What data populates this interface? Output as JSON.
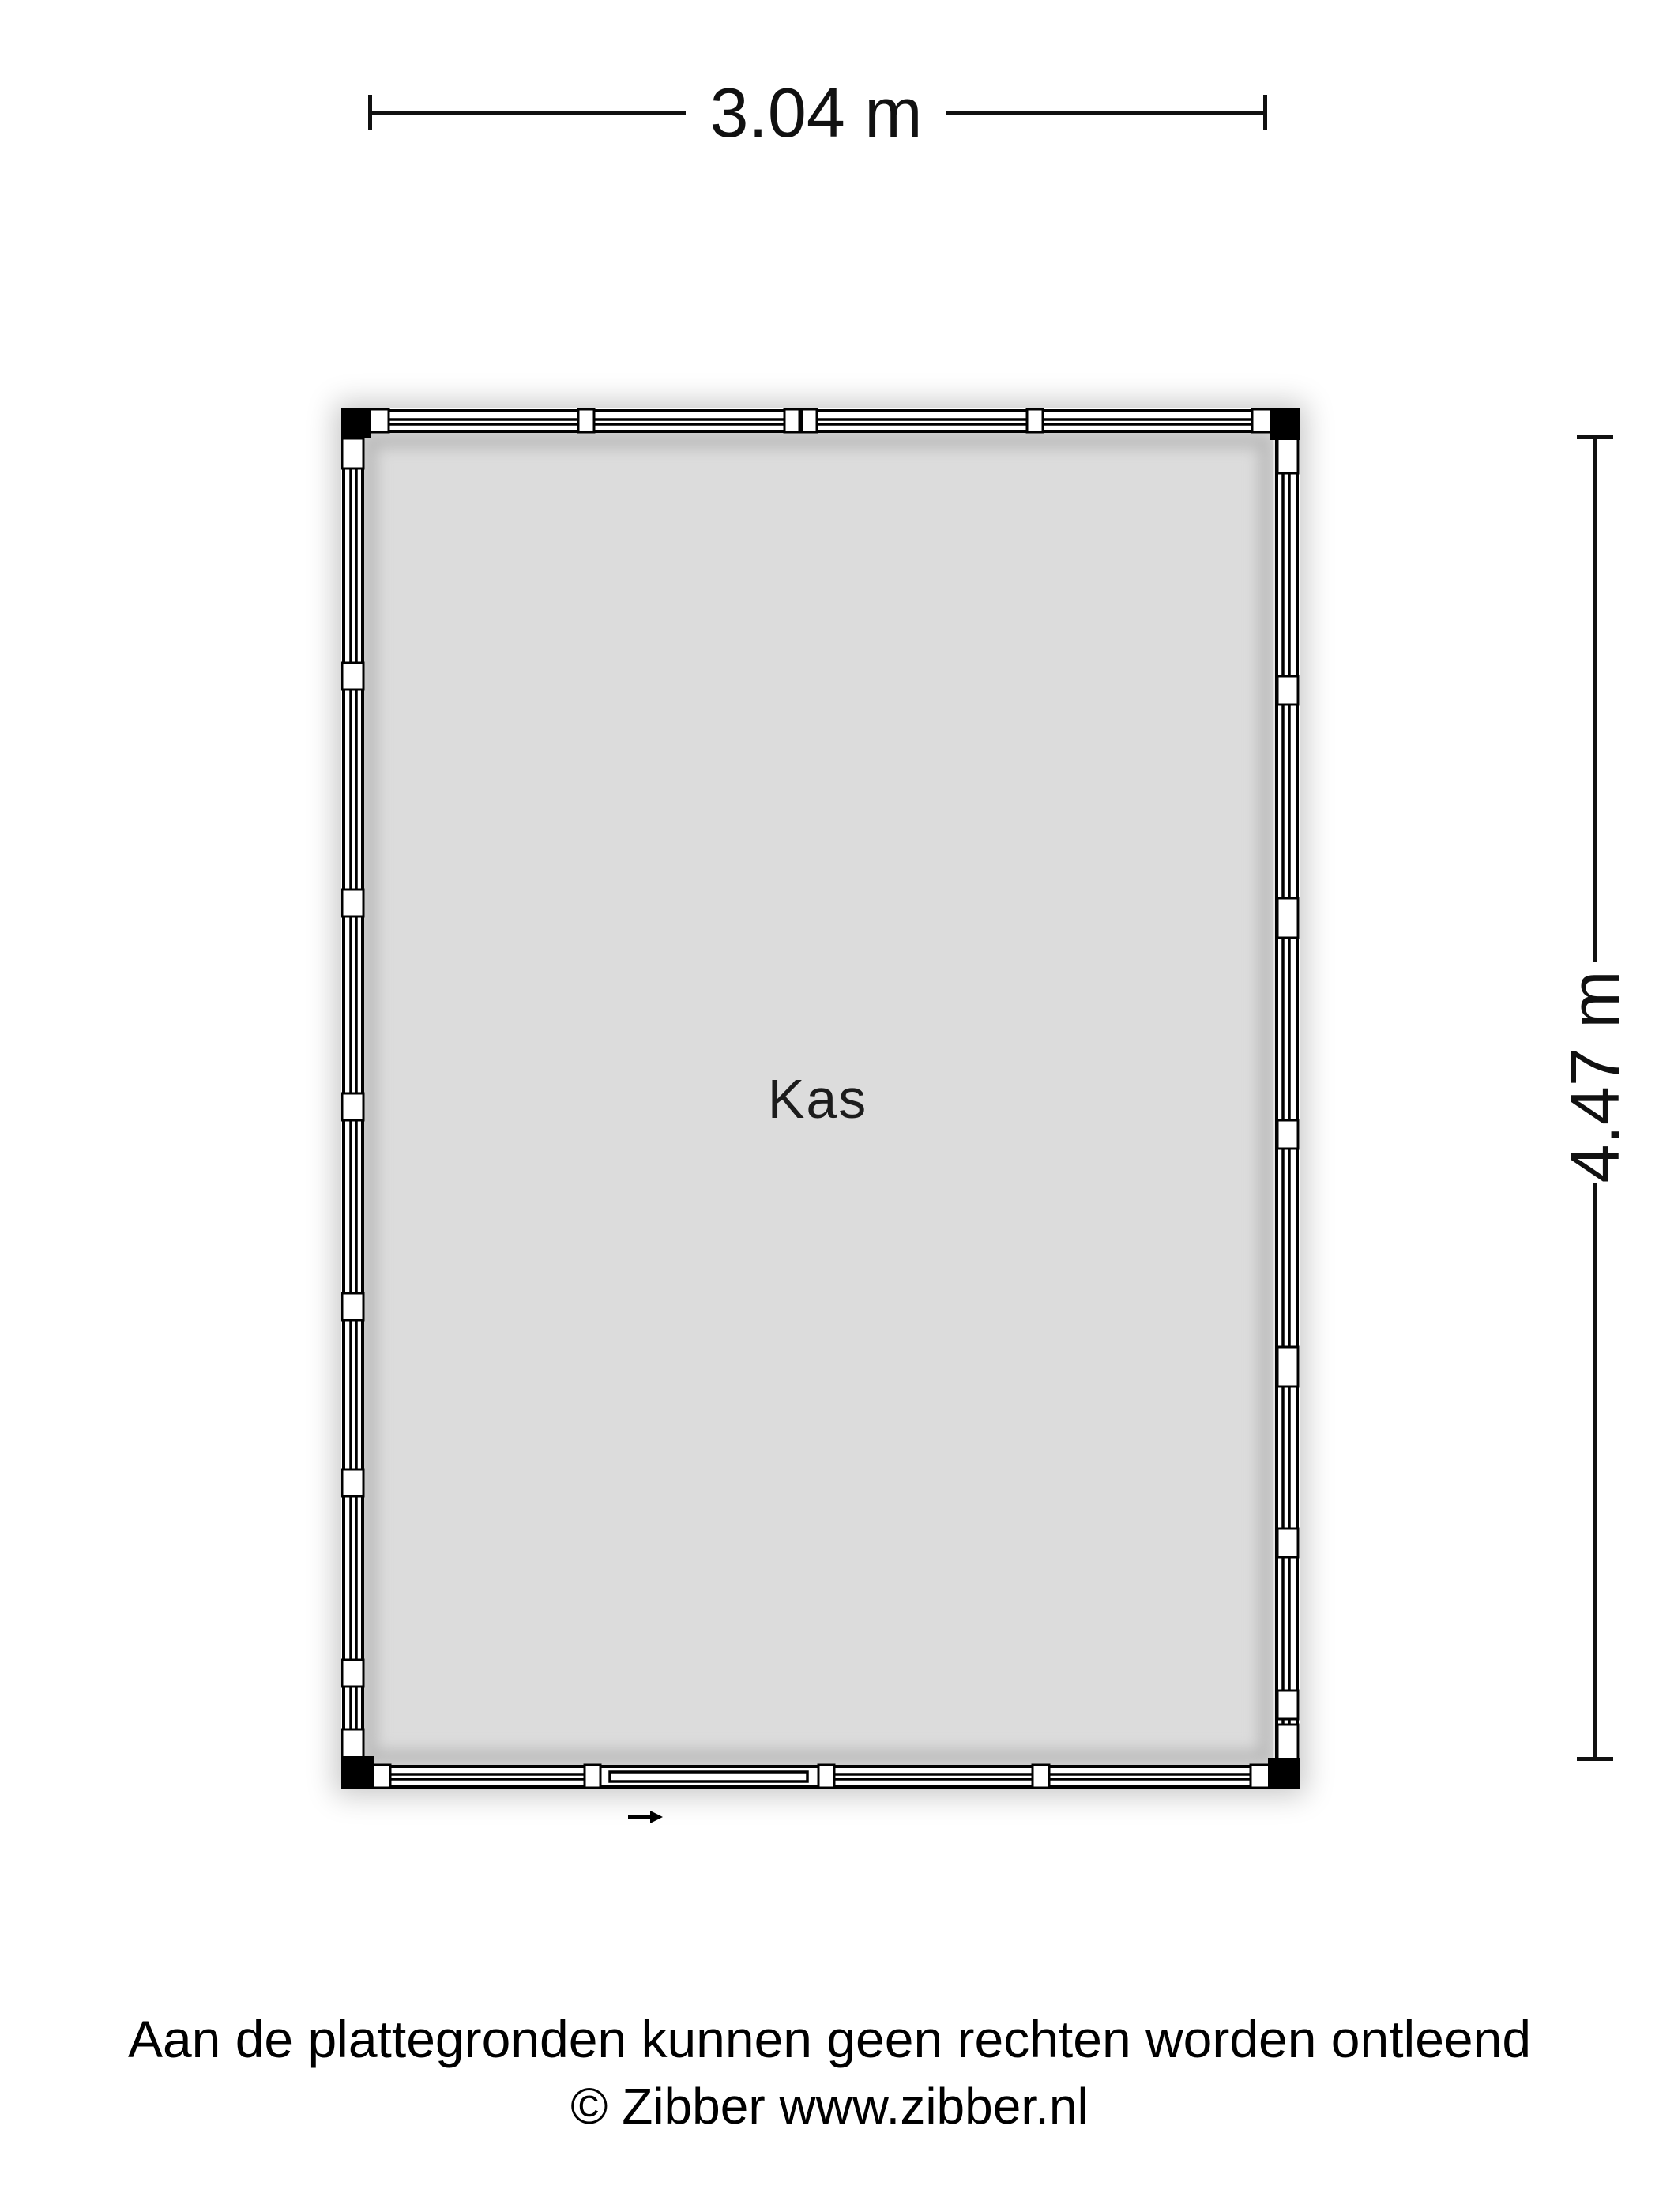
{
  "plan": {
    "room_label": "Kas",
    "width_dimension": "3.04 m",
    "height_dimension": "4.47 m"
  },
  "footer": {
    "disclaimer": "Aan de plattegronden kunnen geen rechten worden ontleend",
    "copyright": "© Zibber www.zibber.nl"
  },
  "icons": {
    "entrance_arrow": "right-arrow-icon"
  },
  "colors": {
    "floor_fill": "#dcdcdc",
    "wall_line": "#000000",
    "background": "#ffffff",
    "corner_post": "#000000"
  }
}
